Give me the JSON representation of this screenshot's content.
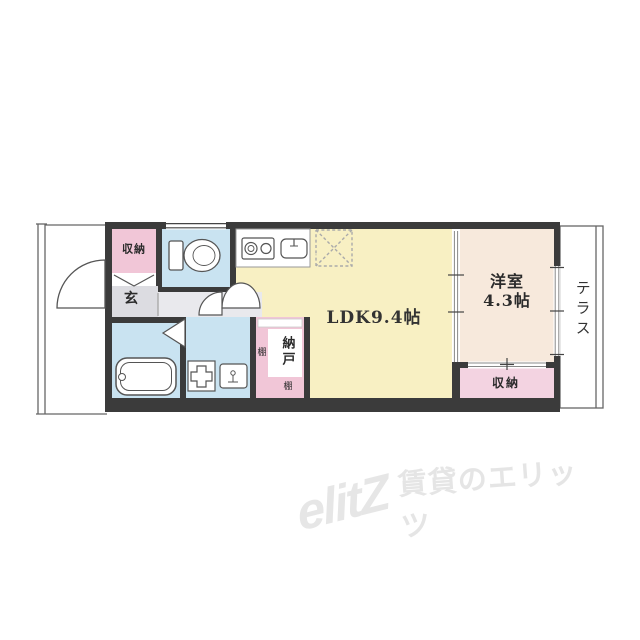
{
  "floorplan": {
    "rooms": {
      "ldk": {
        "label": "LDK9.4帖"
      },
      "western_room": {
        "label_line1": "洋室",
        "label_line2": "4.3帖"
      },
      "terrace": {
        "label": "テラス"
      },
      "entrance": {
        "label": "玄"
      },
      "entrance_closet": {
        "label": "収納"
      },
      "bedroom_closet": {
        "label": "収納"
      },
      "storeroom": {
        "label": "納戸"
      },
      "shelf_left": {
        "label": "棚"
      },
      "shelf_bottom": {
        "label": "棚"
      }
    },
    "colors": {
      "wall": "#3B3B3B",
      "closet_pink": "#F1C6D7",
      "closet_pink_light": "#F3D3E1",
      "water_blue": "#C9E3F1",
      "ldk_yellow": "#F8F0C3",
      "room_beige": "#F7E9DC",
      "entrance_gray": "#DCDCE1",
      "hall_gray": "#E9E9ED",
      "white": "#FFFFFF",
      "line": "#555555"
    }
  },
  "watermark": {
    "logo": "elitZ",
    "text": "賃貸のエリッツ"
  }
}
